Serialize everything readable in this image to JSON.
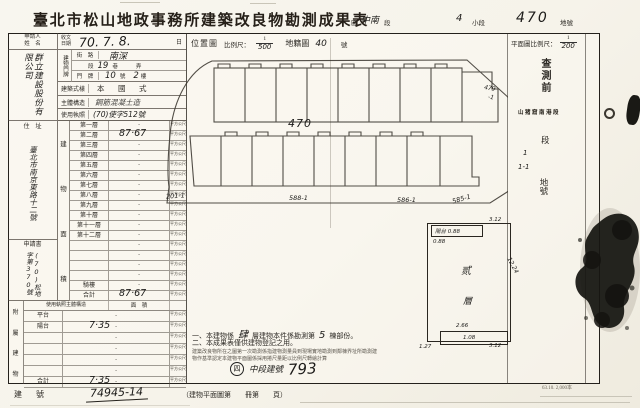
{
  "colors": {
    "paper": "#f8f6ef",
    "ink": "#2b2823",
    "accent": "#1c1b19"
  },
  "title": "臺北市松山地政事務所建築改良物勘測成果表",
  "header": {
    "district_label": "區",
    "district_hw": "中南",
    "section_label": "段",
    "subsection_hw": "4",
    "subsection_label": "小段",
    "lot_hw": "470",
    "lot_label": "地號"
  },
  "left": {
    "applicant_label1": "申請人",
    "applicant_label2": "姓　名",
    "receipt_label1": "收文",
    "receipt_label2": "日期",
    "receipt_hw": "70. 7. 8.",
    "receipt_suffix": "日",
    "company_hw": "群立建設股份有限公司",
    "door_label": "建物門牌",
    "street_label": "街　路",
    "street_hw": "南深",
    "lane_label_1": "段",
    "lane_hw": "19",
    "lane_label_2": "巷",
    "lane_label_3": "弄",
    "number_label": "門　牌",
    "number_hw_1": "10",
    "number_label_2": "號",
    "number_hw_2": "2",
    "number_label_3": "樓",
    "style_label": "建築式樣",
    "style_value": "本　國　式",
    "structure_label": "主體構造",
    "structure_hw": "鋼筋混凝土造",
    "license_label": "使用執照",
    "license_hw": "(70)使字512號",
    "address_label": "住　址",
    "address_hw": "臺北市南京東路十二號",
    "application_label": "申請書",
    "application_hw": "(70)松地字第370號",
    "area_chars": [
      "建",
      "物",
      "面",
      "積"
    ],
    "dot": "·",
    "unit_small": "平方公尺",
    "floors": [
      {
        "label": "第一層",
        "hw": ""
      },
      {
        "label": "第二層",
        "hw": "87·67"
      },
      {
        "label": "第三層",
        "hw": ""
      },
      {
        "label": "第四層",
        "hw": ""
      },
      {
        "label": "第五層",
        "hw": ""
      },
      {
        "label": "第六層",
        "hw": ""
      },
      {
        "label": "第七層",
        "hw": ""
      },
      {
        "label": "第八層",
        "hw": ""
      },
      {
        "label": "第九層",
        "hw": ""
      },
      {
        "label": "第十層",
        "hw": ""
      },
      {
        "label": "第十一層",
        "hw": ""
      },
      {
        "label": "第十二層",
        "hw": ""
      },
      {
        "label": "",
        "hw": ""
      },
      {
        "label": "",
        "hw": ""
      },
      {
        "label": "",
        "hw": ""
      },
      {
        "label": "",
        "hw": ""
      },
      {
        "label": "騎樓",
        "hw": ""
      },
      {
        "label": "合計",
        "hw": "87·67"
      }
    ],
    "annex_label_chars": [
      "附",
      "屬",
      "建",
      "物"
    ],
    "annex_header_1": "使用執照主體構造",
    "annex_header_2": "面　積",
    "annex_rows": [
      {
        "label": "平台",
        "hw": ""
      },
      {
        "label": "陽台",
        "hw": "7·35"
      },
      {
        "label": "",
        "hw": ""
      },
      {
        "label": "",
        "hw": ""
      },
      {
        "label": "",
        "hw": ""
      },
      {
        "label": "",
        "hw": ""
      },
      {
        "label": "合計",
        "hw": "7·35"
      }
    ],
    "reg_label": "建　號",
    "reg_hw": "74945-14"
  },
  "diagram": {
    "loc_label": "位置圖",
    "scale_label": "比例尺：",
    "scale_num": "1",
    "scale_den_hw": "500",
    "map_label": "地籍圖",
    "map_no_hw": "40",
    "map_no_suffix": "號",
    "plan_scale_label": "平面圖比例尺：",
    "plan_num": "1",
    "plan_den_hw": "200",
    "center_lot_hw": "470",
    "lot_labels": [
      {
        "text": "201-1"
      },
      {
        "text": "588-1"
      },
      {
        "text": "586-1"
      },
      {
        "text": "585-1"
      }
    ],
    "side_lot_hw_1": "479",
    "side_lot_hw_2": "-1",
    "survey_col": {
      "pre_label": "查測前",
      "old_section": "山猪窟南港段",
      "hw_a": "1",
      "hw_b": "1-1",
      "section_label": "段",
      "lot_label": "地號",
      "numbers": [
        "200-11",
        "209-17",
        "-22",
        "206",
        "306-6",
        "308",
        "329-1",
        "-16"
      ]
    },
    "floorplan": {
      "balcony_hw": "陽台 0.88",
      "balcony_w_hw": "0.88",
      "top_w_hw": "3.12",
      "right_h_hw": "12.24",
      "unit_hw_1": "贰",
      "unit_hw_2": "層",
      "bottom_len_hw": "2.66",
      "bottom_in_hw": "1.08",
      "bottom_r_hw": "3.12",
      "bottom_l_hw": "1.27"
    }
  },
  "notes": {
    "n1_a": "一、本建物係",
    "n1_hw1": "肆",
    "n1_b": "層建物本件係勘測第",
    "n1_hw2": "5",
    "n1_c": "棟部份。",
    "n2": "二、本成果表僅供建物登記之用。",
    "small_1": "建築改良物所在之圖第一次勘測係指建物測量員到現場實地勘測到鄰棟界址所勘測建",
    "small_2": "物作基準認定本建物平面圖係採用捲尺量距以比例尺轉繪計算",
    "circle_hw": "四",
    "reg_hw_label": "中段建號",
    "reg_hw_no": "793"
  },
  "footer": {
    "plan_book": "（建物平面圖第　　冊第　　頁）",
    "print_note": "63.10. 2,000本"
  }
}
